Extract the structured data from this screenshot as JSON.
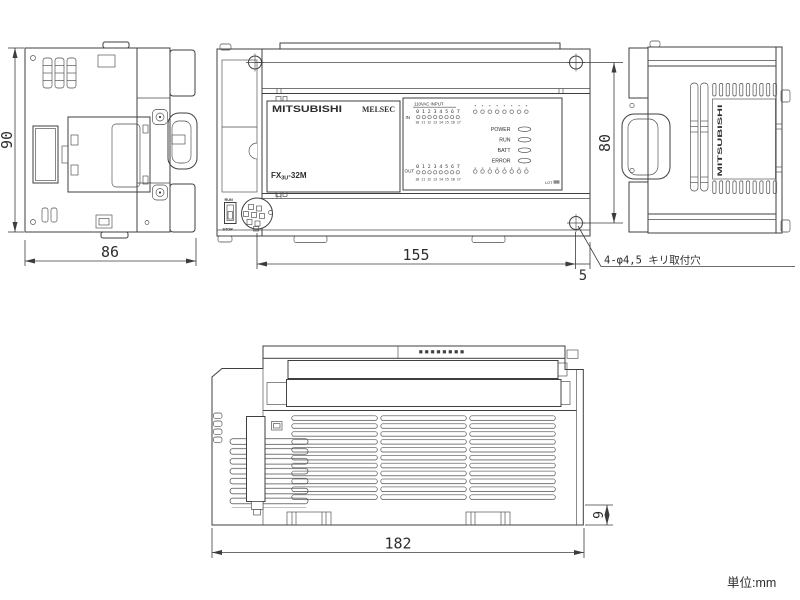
{
  "unit_note": "単位:mm",
  "callout_mounting_hole": "4-φ4,5 キリ取付穴",
  "dims": {
    "side_height": "90",
    "side_width": "86",
    "hole_span": "155",
    "hole_edge_offset": "5",
    "hole_vspan": "80",
    "body_width": "182",
    "foot_height": "9"
  },
  "front": {
    "brand": "MITSUBISHI",
    "series": "MELSEC",
    "model_prefix": "FX",
    "model_sub": "3U",
    "model_suffix": "-32M",
    "run_label": "RUN",
    "stop_label": "STOP",
    "led_panel": {
      "input_title": "110VAC INPUT",
      "in_label": "IN",
      "out_label": "OUT",
      "lot_label": "LOT",
      "status_leds": [
        "POWER",
        "RUN",
        "BATT",
        "ERROR"
      ],
      "in_top": [
        "0",
        "1",
        "2",
        "3",
        "4",
        "5",
        "6",
        "7"
      ],
      "in_bottom": [
        "10",
        "11",
        "12",
        "13",
        "14",
        "15",
        "16",
        "17"
      ],
      "out_top": [
        "0",
        "1",
        "2",
        "3",
        "4",
        "5",
        "6",
        "7"
      ],
      "out_bottom": [
        "10",
        "11",
        "12",
        "13",
        "14",
        "15",
        "16",
        "17"
      ]
    }
  },
  "side_right": {
    "brand_vertical": "MITSUBISHI"
  }
}
